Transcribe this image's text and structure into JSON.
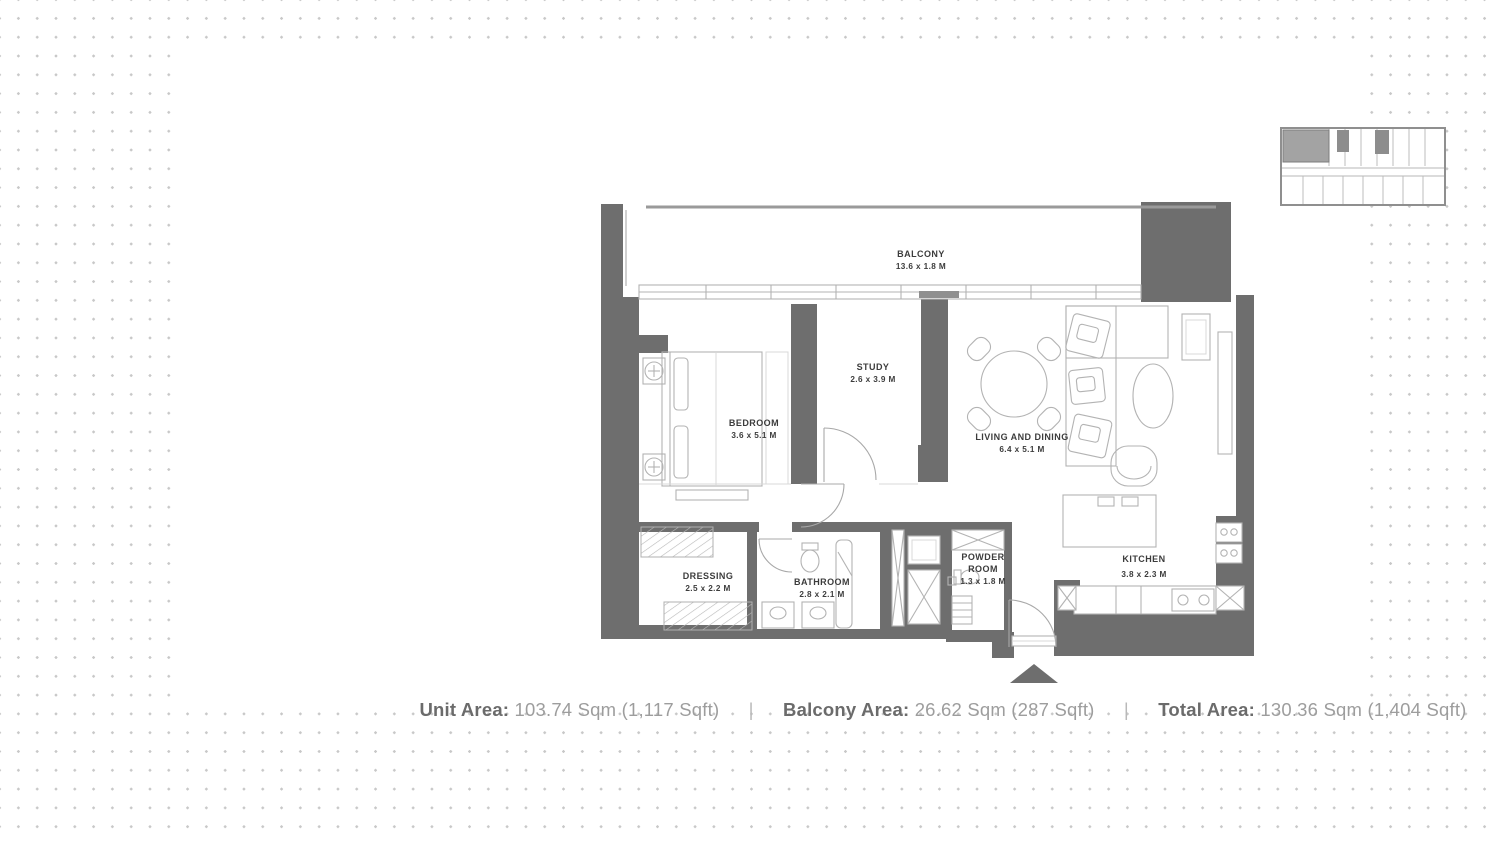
{
  "floor_plan": {
    "rooms": {
      "balcony": {
        "name": "BALCONY",
        "dims": "13.6 x 1.8 M"
      },
      "bedroom": {
        "name": "BEDROOM",
        "dims": "3.6 x 5.1 M"
      },
      "study": {
        "name": "STUDY",
        "dims": "2.6 x 3.9 M"
      },
      "living_dining": {
        "name": "LIVING AND DINING",
        "dims": "6.4 x 5.1 M"
      },
      "dressing": {
        "name": "DRESSING",
        "dims": "2.5 x 2.2 M"
      },
      "bathroom": {
        "name": "BATHROOM",
        "dims": "2.8 x 2.1 M"
      },
      "powder_room": {
        "line1": "POWDER",
        "line2": "ROOM",
        "dims": "1.3 x 1.8 M"
      },
      "kitchen": {
        "name": "KITCHEN",
        "dims": "3.8 x 2.3 M"
      }
    }
  },
  "footer": {
    "unit_area": {
      "label": "Unit Area:",
      "value": "103.74 Sqm (1,117 Sqft)"
    },
    "balcony_area": {
      "label": "Balcony Area:",
      "value": "26.62 Sqm (287 Sqft)"
    },
    "total_area": {
      "label": "Total Area:",
      "value": "130.36 Sqm (1,404 Sqft)"
    },
    "separator": "|"
  },
  "colors": {
    "wall-color": "#6e6e6e",
    "furn-color": "#b3b3b3",
    "label-color": "#3c3c3c",
    "footer-label-color": "#6b6b6b",
    "footer-value-color": "#9d9d9d",
    "dot-color": "#c8c8c8",
    "keyplan-highlight": "#a3a3a3"
  }
}
